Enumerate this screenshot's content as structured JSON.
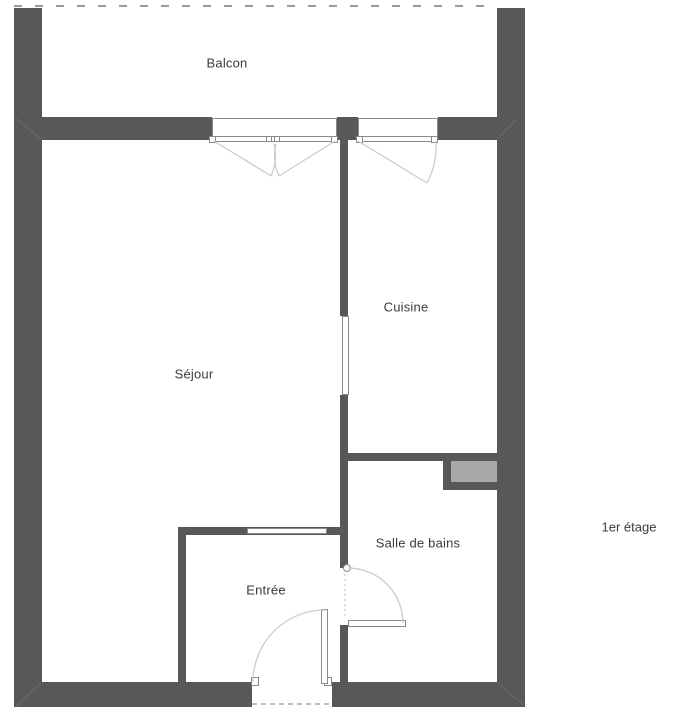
{
  "plan": {
    "floor_label": "1er étage",
    "rooms": [
      {
        "id": "balcon",
        "label": "Balcon"
      },
      {
        "id": "sejour",
        "label": "Séjour"
      },
      {
        "id": "cuisine",
        "label": "Cuisine"
      },
      {
        "id": "salle_de_bains",
        "label": "Salle de bains"
      },
      {
        "id": "entree",
        "label": "Entrée"
      }
    ],
    "colors": {
      "background": "#ffffff",
      "wall": "#585858",
      "duct_fill": "#a8a8a8",
      "window_border": "#8a8a8a",
      "door_arc": "#cccccc",
      "dashed_line": "#9a9a9a",
      "text": "#3a3a3a"
    }
  }
}
